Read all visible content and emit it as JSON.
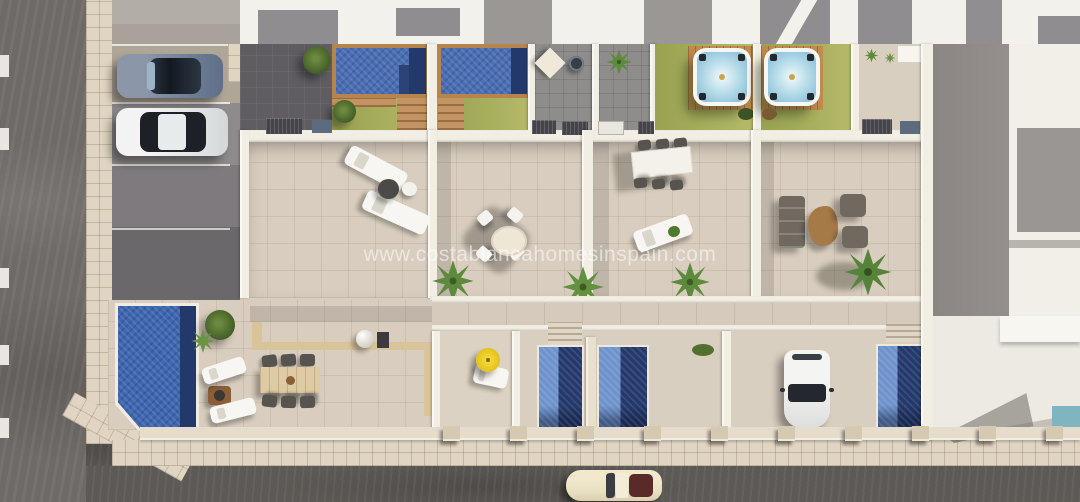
{
  "watermark": {
    "text": "www.costablancahomesinspain.com"
  },
  "palette": {
    "pool_blue": "#4a6db3",
    "pool_shadow_navy": "#24396b",
    "hot_tub_water": "#bfe0ec",
    "lawn_green": "#a7ae5c",
    "wood_deck": "#c08b4f",
    "patio_tile": "#d8cdbe",
    "road_asphalt": "#6e6a67",
    "parasol_yellow": "#e6c51f",
    "neighbor_pool_teal": "#7fb5c0"
  },
  "inventory": {
    "large_top_pools": 2,
    "hot_tubs": 2,
    "lower_pools": 4,
    "parked_cars": 4,
    "dining_sets": 3,
    "sun_loungers": 7
  }
}
